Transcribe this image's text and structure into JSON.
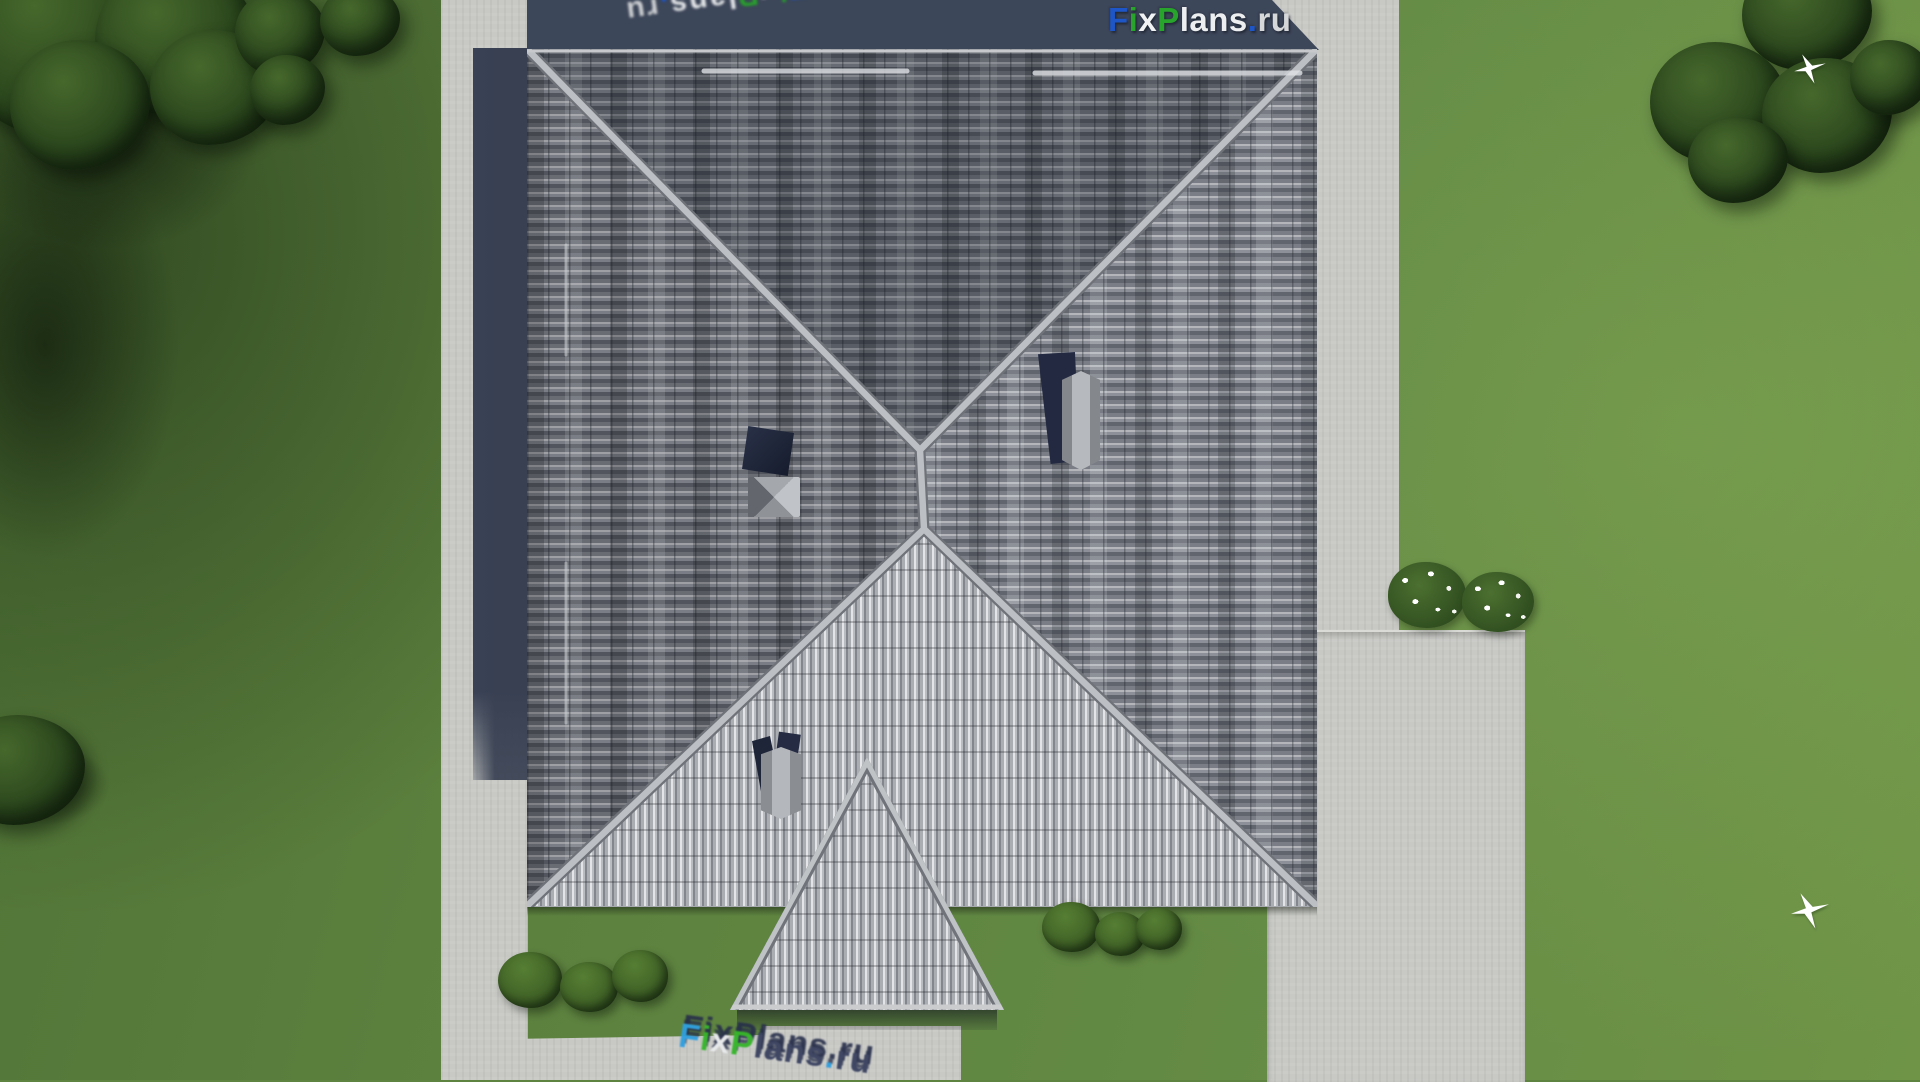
{
  "page": {
    "kind": "3d-architectural-render",
    "description": "Top-down aerial 3D render of a hip-roofed house with a gabled porch, two chimneys, a roof window, concrete paths, a patio, lawn, trees, shrubs, flowering bushes and two white birds"
  },
  "brand": {
    "name": "FixPlans.ru",
    "letters_main": [
      {
        "ch": "F",
        "color": "#1e56c8"
      },
      {
        "ch": "i",
        "color": "#28a32c"
      },
      {
        "ch": "x",
        "color": "#f0f2f4"
      },
      {
        "ch": "P",
        "color": "#28a32c"
      },
      {
        "ch": "l",
        "color": "#eceef0"
      },
      {
        "ch": "a",
        "color": "#eceef0"
      },
      {
        "ch": "n",
        "color": "#eceef0"
      },
      {
        "ch": "s",
        "color": "#eceef0"
      },
      {
        "ch": ".",
        "color": "#1e56c8"
      },
      {
        "ch": "r",
        "color": "#d5d7d9"
      },
      {
        "ch": "u",
        "color": "#d5d7d9"
      }
    ],
    "letters_bottom": [
      {
        "ch": "F",
        "color": "#2f9fe0"
      },
      {
        "ch": "i",
        "color": "#35b52a"
      },
      {
        "ch": "x",
        "color": "#e8eaec"
      },
      {
        "ch": "P",
        "color": "#35b52a"
      },
      {
        "ch": "l",
        "color": "#3a4260"
      },
      {
        "ch": "a",
        "color": "#3a4260"
      },
      {
        "ch": "n",
        "color": "#3a4260"
      },
      {
        "ch": "s",
        "color": "#3a4260"
      },
      {
        "ch": ".",
        "color": "#2f9fe0"
      },
      {
        "ch": "r",
        "color": "#3a4260"
      },
      {
        "ch": "u",
        "color": "#3a4260"
      }
    ],
    "watermarks": {
      "top_right": "horizontal logo over roof shadow strip",
      "top_left": "upside-down tilted logo clipped by top edge, rotation 172deg",
      "bottom_center": "tilted extruded logo on walkway clipped by bottom edge, rotation 8deg"
    }
  },
  "palette": {
    "concrete": "#c8c9c5",
    "shadow-navy": "#3d475a",
    "chimney-navy": "#222941",
    "lawn": "#5e8340",
    "lawn-light": "#6f9447",
    "tree-green": "#2b471d",
    "bush-green": "#3f6126",
    "roof-dark-row": "#5a5e66",
    "roof-light-row": "#b0b3b8",
    "roof-front": "#c0c2c5",
    "ridge-cap": "#bcbfc3",
    "flower-white": "#ffffff",
    "bird-white": "#ffffff"
  }
}
